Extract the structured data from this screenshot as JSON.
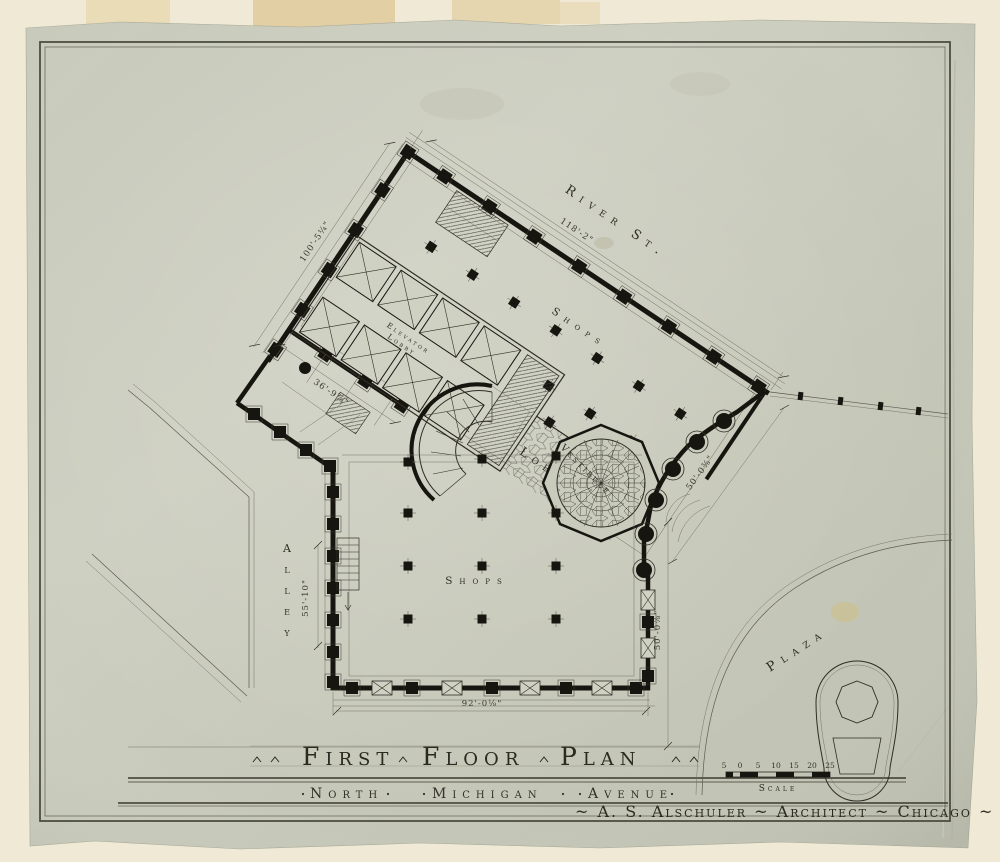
{
  "drawing": {
    "kind": "architectural first floor plan, ink on linen",
    "colors": {
      "mat": "#efe8d3",
      "sheet": "#c9cbbd",
      "ink": "#2f2d23",
      "wall_black": "#17150f",
      "tape_stain": "#e0cda4",
      "yellow_stain": "#cdbd7e"
    }
  },
  "labels": {
    "river_st": "River St.",
    "shops_upper": "Shops",
    "shops_lower": "Shops",
    "elevator_lobby_line1": "Elevator",
    "elevator_lobby_line2": "Lobby",
    "lobby": "Lobby",
    "vestibule": "Vestibule",
    "alley": "Alley",
    "plaza": "Plaza"
  },
  "dimensions": {
    "river_front": "118'-2\"",
    "northwest_side": "100'-5¼\"",
    "southwest_side": "36'-9⅞\"",
    "southeast_side": "50'-0⅜\"",
    "plaza_front": "50'-0⅞\"",
    "south_front": "92'-0⅛\"",
    "alley_width": "55'-10\""
  },
  "titleblock": {
    "title_word1": "First",
    "title_word2": "Floor",
    "title_word3": "Plan",
    "subtitle_word1": "North",
    "subtitle_word2": "Michigan",
    "subtitle_word3": "Avenue",
    "credit": "~ A. S. Alschuler ~ Architect ~ Chicago ~"
  },
  "scale_bar": {
    "label": "Scale",
    "ticks": [
      "5",
      "0",
      "5",
      "10",
      "15",
      "20",
      "25"
    ]
  }
}
